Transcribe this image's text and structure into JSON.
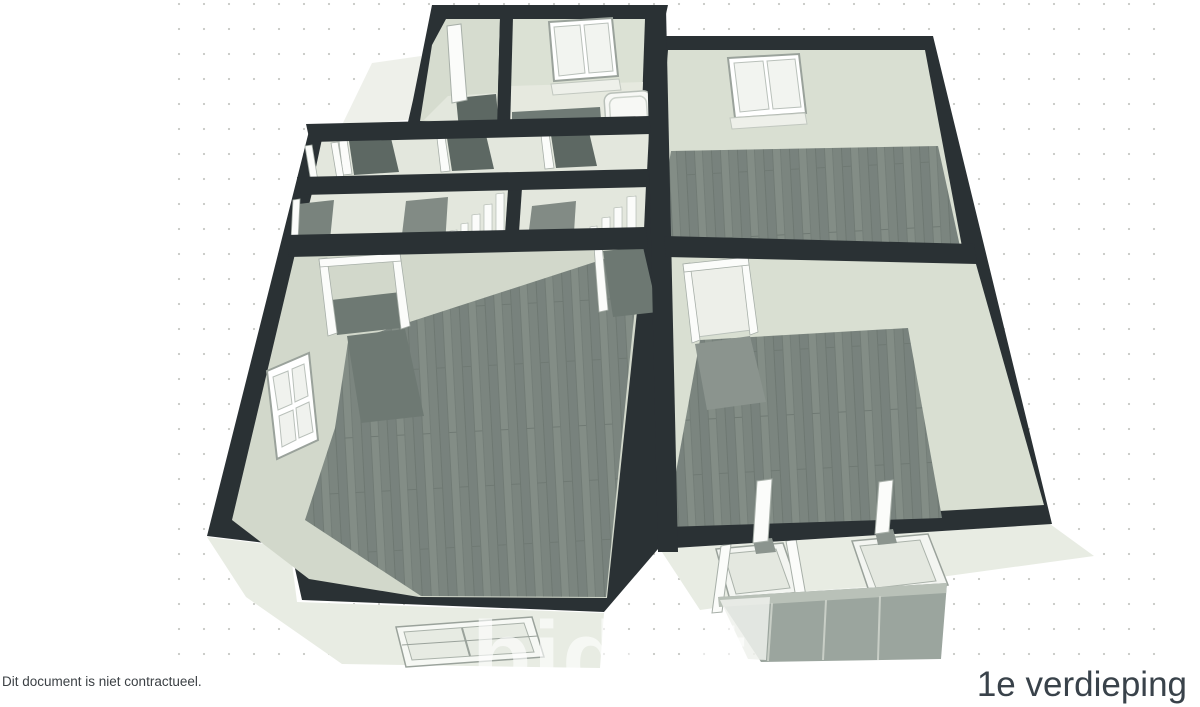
{
  "window": {
    "width": 1200,
    "height": 707
  },
  "background": {
    "color": "#ffffff",
    "dot_color": "#c6c8c4"
  },
  "floorplan": {
    "kind": "3d-floor-plan-render",
    "floor_label": "1e verdieping",
    "disclaimer": "Dit document is niet contractueel.",
    "watermark_brand": "biddit",
    "palette": {
      "wall_top": "#2a3134",
      "wall_face_north": "#dbe1d4",
      "wall_face_west": "#ccd3c5",
      "floor_wood": "#7e8882",
      "floor_light": "#e3e7dd",
      "exterior_face": "#e8ece3",
      "balcony_glass": "#9ba59e",
      "door_shadow": "#5d6863",
      "fixture_white": "#f7f8f5"
    }
  }
}
